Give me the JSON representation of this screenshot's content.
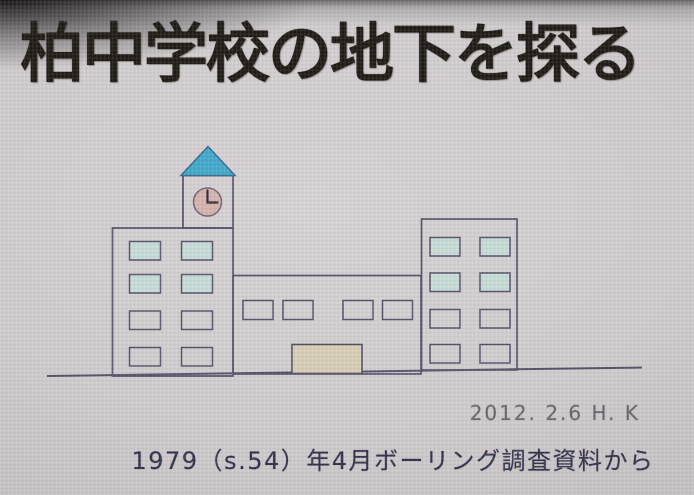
{
  "slide": {
    "title": "柏中学校の地下を探る",
    "credit": "2012. 2.6 H. K",
    "caption": "1979（s.54）年4月ボーリング調査資料から"
  },
  "illustration": {
    "subject": "school building line drawing with clock tower",
    "clock_time": "3:00",
    "left_wing_window_count": 8,
    "middle_wing_window_count": 4,
    "right_wing_window_count": 8,
    "tinted_window_rows": "top two rows of each wing"
  },
  "colors": {
    "title-ink": "#201b16",
    "caption-ink": "#34334b",
    "credit-ink": "#6b676d",
    "outline": "#56526a",
    "roof-blue": "#44a9cd",
    "clock-face": "#d6b5ad",
    "window-tint": "#c8ddd8",
    "door-beige": "#d8cfb7",
    "screen-gray": "#cdc9cb",
    "vignette-edge": "#8b8789"
  }
}
